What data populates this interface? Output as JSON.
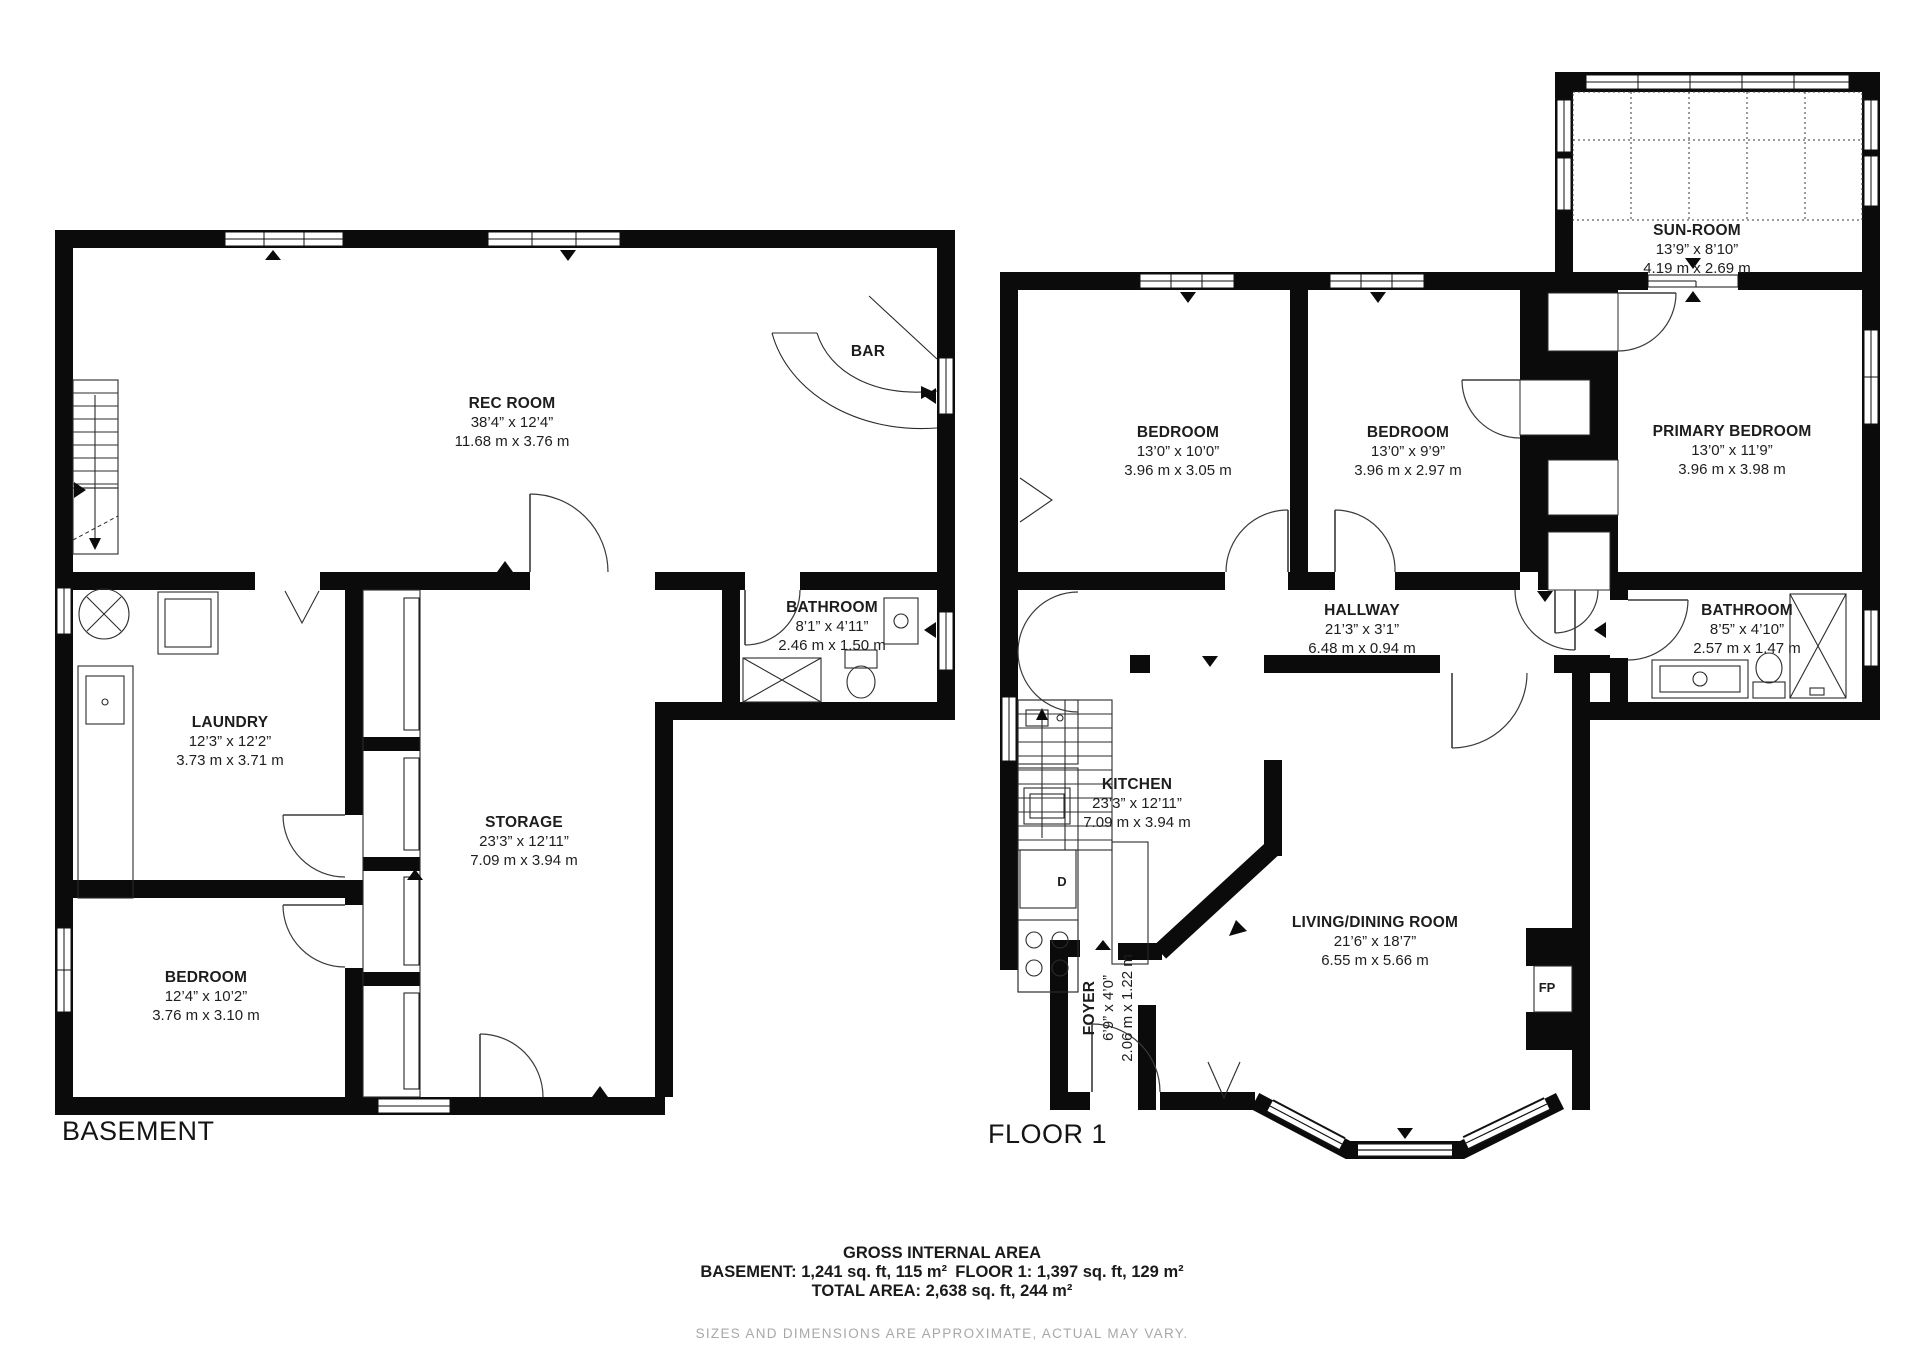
{
  "basement": {
    "label": "BASEMENT",
    "rec_room": {
      "name": "REC ROOM",
      "imperial": "38’4” x 12’4”",
      "metric": "11.68 m x 3.76 m"
    },
    "bar_label": "BAR",
    "bathroom": {
      "name": "BATHROOM",
      "imperial": "8’1” x 4’11”",
      "metric": "2.46 m x 1.50 m"
    },
    "laundry": {
      "name": "LAUNDRY",
      "imperial": "12’3” x 12’2”",
      "metric": "3.73 m x 3.71 m"
    },
    "storage": {
      "name": "STORAGE",
      "imperial": "23’3” x 12’11”",
      "metric": "7.09 m x 3.94 m"
    },
    "bedroom": {
      "name": "BEDROOM",
      "imperial": "12’4” x 10’2”",
      "metric": "3.76 m x 3.10 m"
    }
  },
  "floor1": {
    "label": "FLOOR 1",
    "sun_room": {
      "name": "SUN-ROOM",
      "imperial": "13’9” x 8’10”",
      "metric": "4.19 m x 2.69 m"
    },
    "bedroom_left": {
      "name": "BEDROOM",
      "imperial": "13’0” x 10’0”",
      "metric": "3.96 m x 3.05 m"
    },
    "bedroom_middle": {
      "name": "BEDROOM",
      "imperial": "13’0” x 9’9”",
      "metric": "3.96 m x 2.97 m"
    },
    "primary_bedroom": {
      "name": "PRIMARY BEDROOM",
      "imperial": "13’0” x 11’9”",
      "metric": "3.96 m x 3.98 m"
    },
    "hallway": {
      "name": "HALLWAY",
      "imperial": "21’3” x 3’1”",
      "metric": "6.48 m x 0.94 m"
    },
    "bathroom": {
      "name": "BATHROOM",
      "imperial": "8’5” x 4’10”",
      "metric": "2.57 m x 1.47 m"
    },
    "kitchen": {
      "name": "KITCHEN",
      "imperial": "23’3” x 12’11”",
      "metric": "7.09 m x 3.94 m"
    },
    "living_dining": {
      "name": "LIVING/DINING ROOM",
      "imperial": "21’6” x 18’7”",
      "metric": "6.55 m x 5.66 m"
    },
    "foyer": {
      "name": "FOYER",
      "imperial": "6’9” x 4’0”",
      "metric": "2.06 m x 1.22 m"
    },
    "fireplace_label": "FP",
    "dishwasher_label": "D"
  },
  "footer": {
    "title": "GROSS INTERNAL AREA",
    "line1": "BASEMENT: 1,241 sq. ft, 115 m² FLOOR 1: 1,397 sq. ft, 129 m²",
    "line2": "TOTAL AREA: 2,638 sq. ft, 244 m²",
    "disclaimer": "SIZES AND DIMENSIONS ARE APPROXIMATE, ACTUAL MAY VARY."
  },
  "colors": {
    "wall": "#0b0b0b",
    "text": "#1d1d1d",
    "muted": "#a8a8a8"
  }
}
